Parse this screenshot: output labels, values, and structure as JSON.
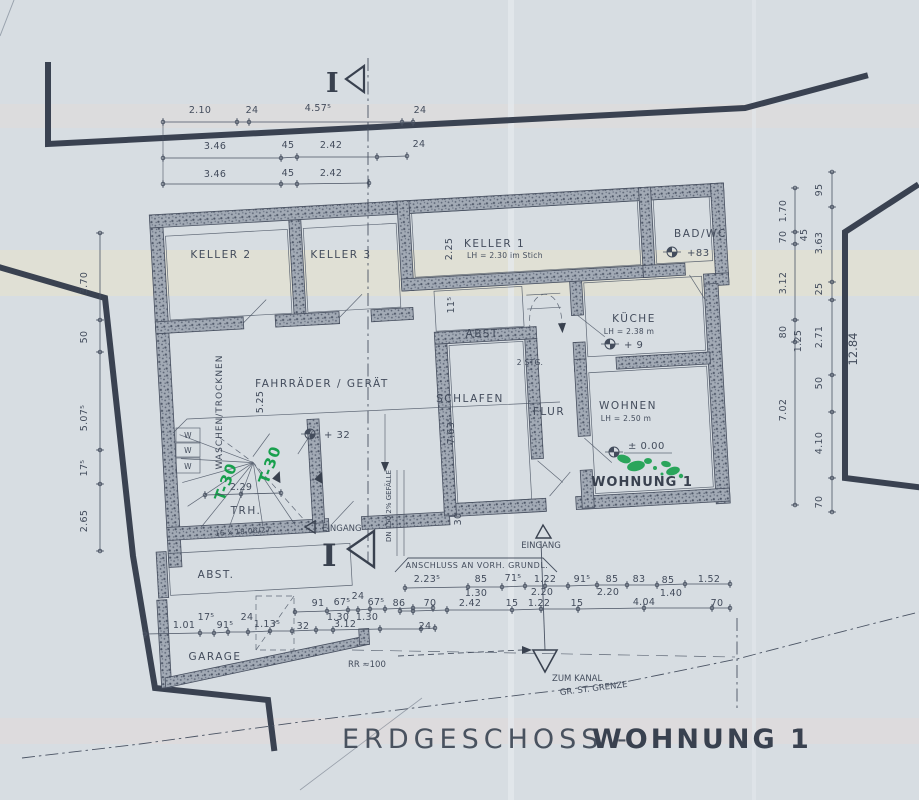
{
  "title": {
    "left": "ERDGESCHOSS -",
    "right": "WOHNUNG 1"
  },
  "rooms": {
    "keller2": {
      "name": "KELLER 2"
    },
    "keller3": {
      "name": "KELLER 3"
    },
    "keller1": {
      "name": "KELLER 1",
      "note": "LH = 2.30 im Stich"
    },
    "bad_wc": {
      "name": "BAD/WC",
      "level": "+83"
    },
    "kueche": {
      "name": "KÜCHE",
      "note": "LH = 2.38 m",
      "level": "+ 9"
    },
    "abst_mitte": {
      "name": "ABST."
    },
    "stg": {
      "name": "2 STG."
    },
    "schlafen": {
      "name": "SCHLAFEN"
    },
    "flur": {
      "name": "FLUR"
    },
    "wohnen": {
      "name": "WOHNEN",
      "note": "LH = 2.50 m",
      "level": "± 0.00"
    },
    "wohnung1": {
      "name": "WOHNUNG 1"
    },
    "fahrraeder": {
      "name": "FAHRRÄDER / GERÄT",
      "level": "+ 32"
    },
    "waschen": {
      "name": "WASCHEN/TROCKNEN"
    },
    "trh": {
      "name": "TRH.",
      "stufen": "16 x 18.06/27"
    },
    "abst_anbau": {
      "name": "ABST."
    },
    "garage": {
      "name": "GARAGE"
    },
    "wasch_geraete": [
      "W",
      "W",
      "W"
    ]
  },
  "annotations": {
    "eingang_seite": "EINGANG",
    "eingang_sued": "EINGANG",
    "anschluss": "ANSCHLUSS AN VORH. GRUNDL.",
    "zum_kanal": "ZUM KANAL",
    "grenze": "GR. ST. GRENZE",
    "rr": "RR ≈100",
    "gefaelle": "DN 150 2% GEFÄLLE",
    "t30_1": "T-30",
    "t30_2": "T-30",
    "schnitt": "I"
  },
  "dimensions": {
    "top_row1": [
      "2.10",
      "24",
      "4.57⁵",
      "24"
    ],
    "top_row2": [
      "3.46",
      "45",
      "2.42",
      "24"
    ],
    "top_row3": [
      "3.46",
      "45",
      "2.42"
    ],
    "left_col": [
      "3.70",
      "50",
      "5.07⁵",
      "17⁵",
      "2.65"
    ],
    "right_inner": [
      "1.70",
      "70",
      "3.12",
      "80",
      "7.02"
    ],
    "right_mid": [
      "45",
      "1.25"
    ],
    "right_outer": [
      "95",
      "3.63",
      "25",
      "2.71",
      "50",
      "4.10",
      "70"
    ],
    "right_grenze": "12.84",
    "innen": {
      "keller1_hoehe": "2.25",
      "wand": "11⁵",
      "halle": "5.25",
      "schlafen_tiefe": "7.63⁵",
      "sued": "30",
      "tuer": "2.29"
    },
    "sued_row1": [
      "2.23⁵",
      "85",
      "71⁵",
      "1.22",
      "91⁵",
      "85",
      "83",
      "85",
      "1.52"
    ],
    "sued_row2": [
      "1.30",
      "2.20",
      "2.20",
      "1.40"
    ],
    "sued_row3": [
      "86",
      "70",
      "2.42",
      "15",
      "1.22",
      "15",
      "4.04",
      "70"
    ],
    "garage_row1": [
      "91",
      "67⁵",
      "24",
      "67⁵"
    ],
    "garage_row1b": [
      "1.30",
      "1.30"
    ],
    "garage_row2": [
      "1.01",
      "17⁵",
      "91⁵",
      "24",
      "1.13⁵",
      "32",
      "3.12",
      "24"
    ]
  },
  "colors": {
    "paper": "#d7dde2",
    "ink": "#454e5e",
    "wall": "#9aa2ad",
    "green": "#18a04d",
    "boundary": "#3a4251"
  }
}
